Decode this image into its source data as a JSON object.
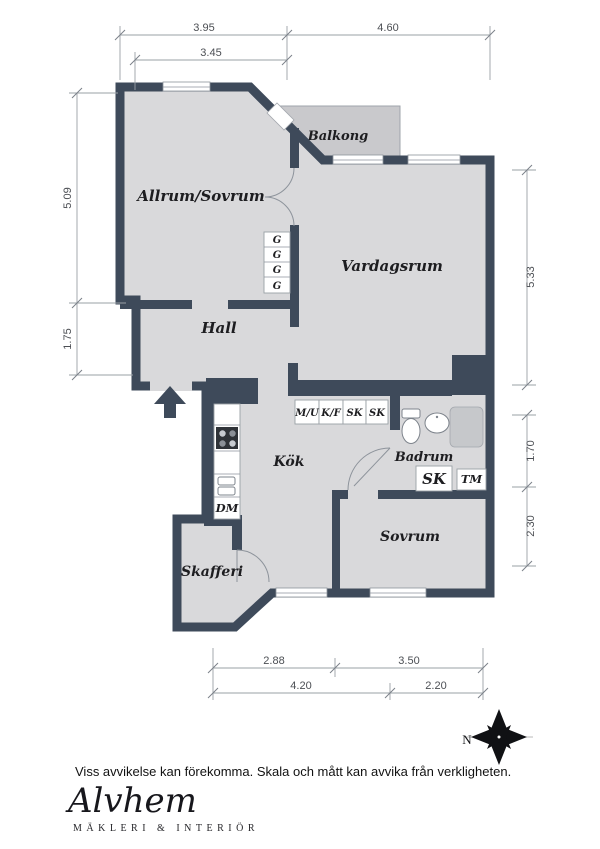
{
  "plan": {
    "room_labels": {
      "allrum": "Allrum/Sovrum",
      "vardagsrum": "Vardagsrum",
      "hall": "Hall",
      "kok": "Kök",
      "badrum": "Badrum",
      "sovrum": "Sovrum",
      "skafferi": "Skafferi",
      "balkong": "Balkong"
    },
    "closet_label": "G",
    "kitchen_cabinets": [
      "M/U",
      "K/F",
      "SK",
      "SK"
    ],
    "appliance_labels": {
      "dm": "DM",
      "sk": "SK",
      "tm": "TM"
    },
    "colors": {
      "wall": "#3e4a5a",
      "floor": "#d9d9db",
      "balcony": "#c9c9cc"
    }
  },
  "dimensions": {
    "top": [
      "3.95",
      "4.60"
    ],
    "top_inner": "3.45",
    "left": [
      "5.09",
      "1.75"
    ],
    "right": [
      "5.33",
      "1.70",
      "2.30"
    ],
    "bottom_upper": [
      "2.88",
      "3.50"
    ],
    "bottom_lower": [
      "4.20",
      "2.20"
    ]
  },
  "compass": {
    "north": "N"
  },
  "footer": {
    "disclaimer": "Viss avvikelse kan förekomma. Skala och mått kan avvika från verkligheten.",
    "brand": "Alvhem",
    "brand_subtitle": "MÄKLERI & INTERIÖR"
  }
}
